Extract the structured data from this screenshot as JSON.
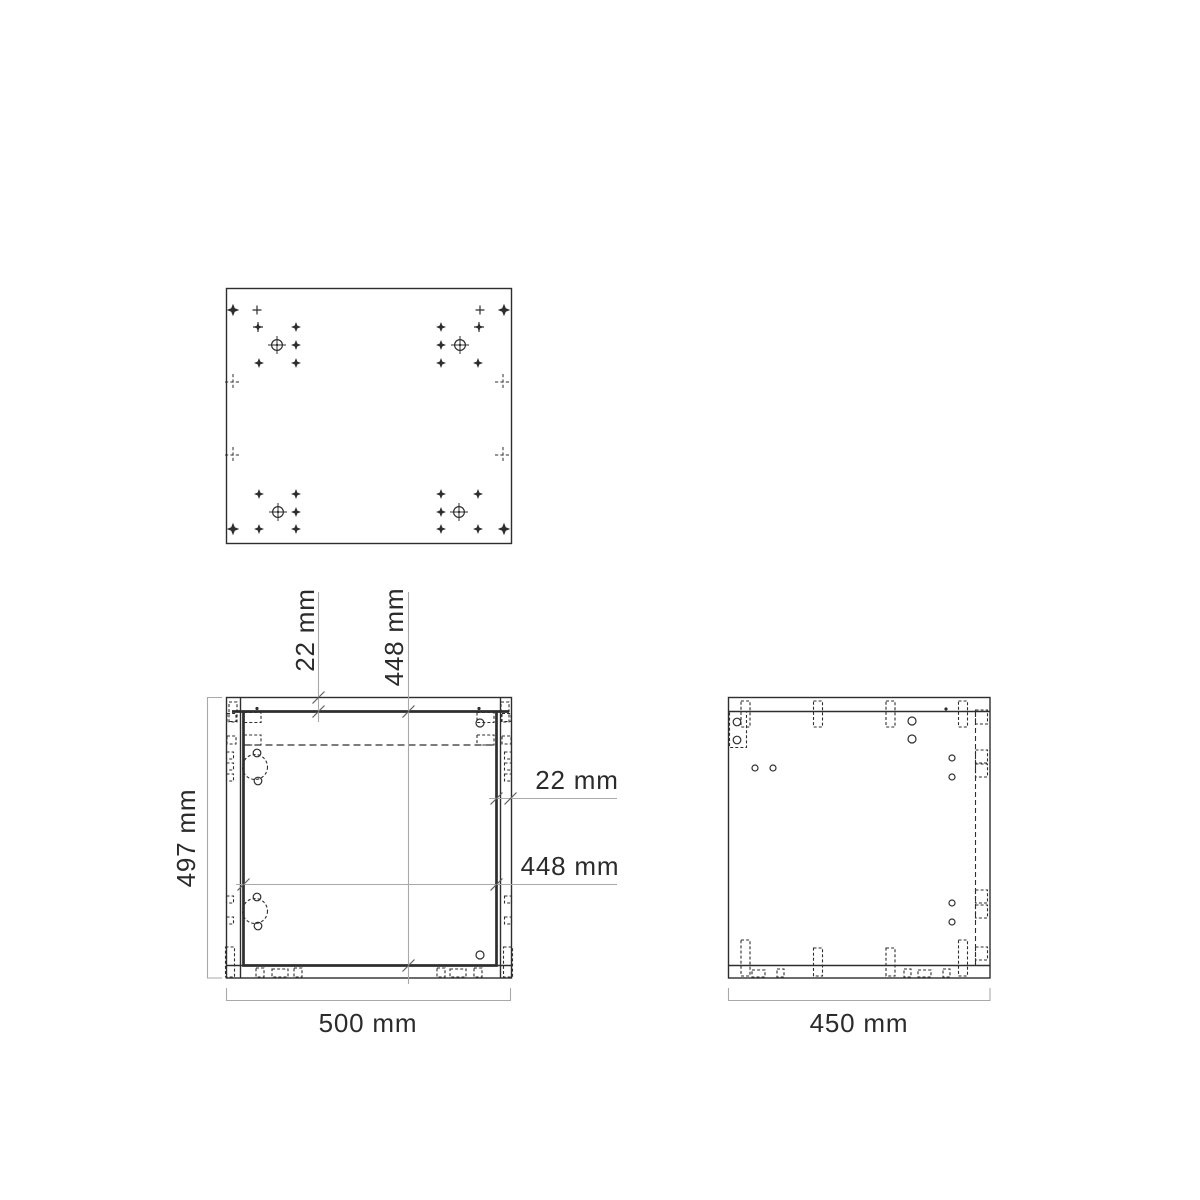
{
  "drawing": {
    "colors": {
      "line": "#2e2e2e",
      "dim": "#a9a9a9",
      "text": "#2b2b2b",
      "bg": "#ffffff"
    },
    "dimensions": {
      "front_height": "497 mm",
      "front_width": "500 mm",
      "side_depth": "450 mm",
      "top_panel_thickness": "22 mm",
      "inner_height": "448 mm",
      "side_panel_thickness": "22 mm",
      "inner_width": "448 mm"
    }
  }
}
